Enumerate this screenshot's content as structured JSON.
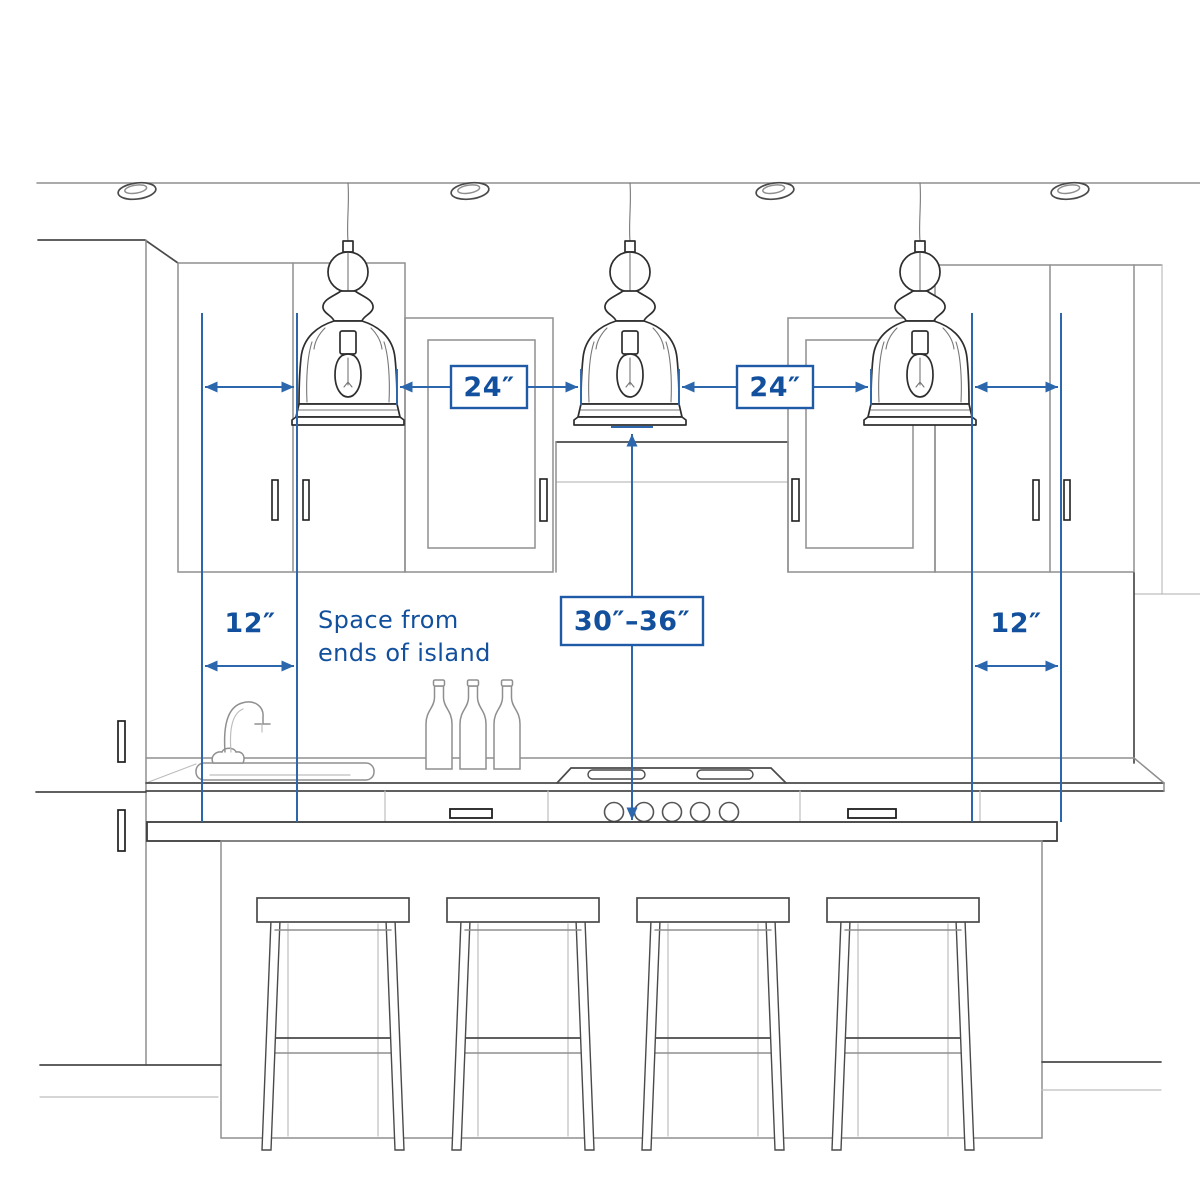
{
  "colors": {
    "annotation_line": "#2c67ad",
    "annotation_border": "#1e5aa6",
    "annotation_text": "#12509d",
    "sketch_dark": "#2e2e2e",
    "sketch_mid": "#8f8f8f",
    "background": "#ffffff"
  },
  "labels": {
    "pendant_gap_left": "24″",
    "pendant_gap_right": "24″",
    "island_end_left": "12″",
    "island_end_right": "12″",
    "pendant_height_range": "30″–36″",
    "note_line1": "Space from",
    "note_line2": "ends of island"
  }
}
